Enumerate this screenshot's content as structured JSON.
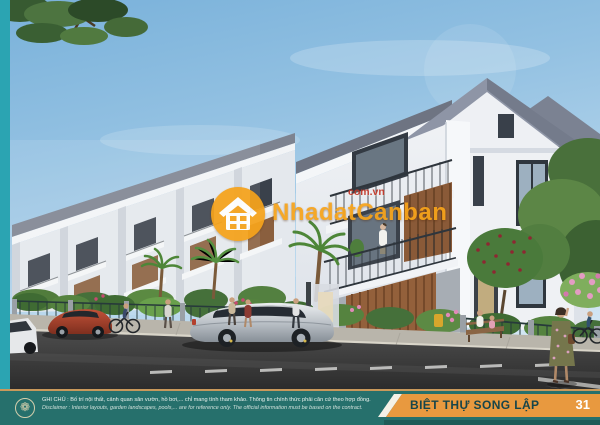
{
  "watermark": {
    "brand": "NhadatCanban",
    "domain": "com.vn"
  },
  "footer": {
    "note_vi": "GHI CHÚ : Bố trí nội thất, cảnh quan sân vườn, hồ bơi,... chỉ mang tính tham khảo. Thông tin chính thức phải căn cứ theo hợp đồng.",
    "note_en": "Disclaimer : Interior layouts, garden landscapes, pools,... are for reference only. The official information must be based on the contract.",
    "property_type": "BIỆT THỰ SONG LẬP",
    "page_number": "31"
  },
  "icons": {
    "footer_seal": "❁",
    "watermark_logo": "house-in-circle"
  },
  "colors": {
    "accent_stripe_teal": "#2BA4B2",
    "footer_teal": "#26706C",
    "footer_line_tan": "#C9995B",
    "band_orange": "#E8993F",
    "band_text_teal": "#17454A",
    "brand_orange": "#F7A41A",
    "brand_red": "#C23527"
  }
}
